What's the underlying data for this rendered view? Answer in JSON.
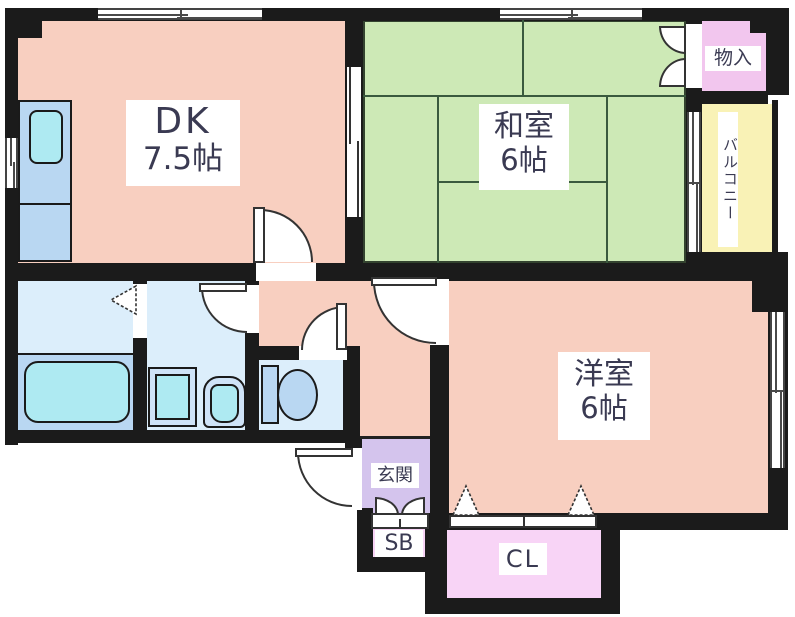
{
  "rooms": {
    "dk": {
      "label": "DK",
      "area": "7.5帖"
    },
    "japanese_room": {
      "label": "和室",
      "area": "6帖"
    },
    "western_room": {
      "label": "洋室",
      "area": "6帖"
    },
    "storage": {
      "label": "物入"
    },
    "balcony": {
      "label": "バルコニー"
    },
    "entrance": {
      "label": "玄関"
    },
    "shoe_box": {
      "label": "SB"
    },
    "closet": {
      "label": "CL"
    }
  },
  "colors": {
    "wall": "#1b1b1b",
    "room_salmon": "#f8cfc0",
    "tatami_green": "#cde9b6",
    "storage_pink": "#f2c6ee",
    "balcony_yellow": "#f9f2b6",
    "entrance_purple": "#d4c4ed",
    "closet_pink": "#f8d4f6",
    "wet_area_blue": "#dceefb",
    "fixture_blue": "#b9d7f2",
    "fixture_cyan": "#aeeaf2",
    "label_text": "#3a3a52"
  }
}
